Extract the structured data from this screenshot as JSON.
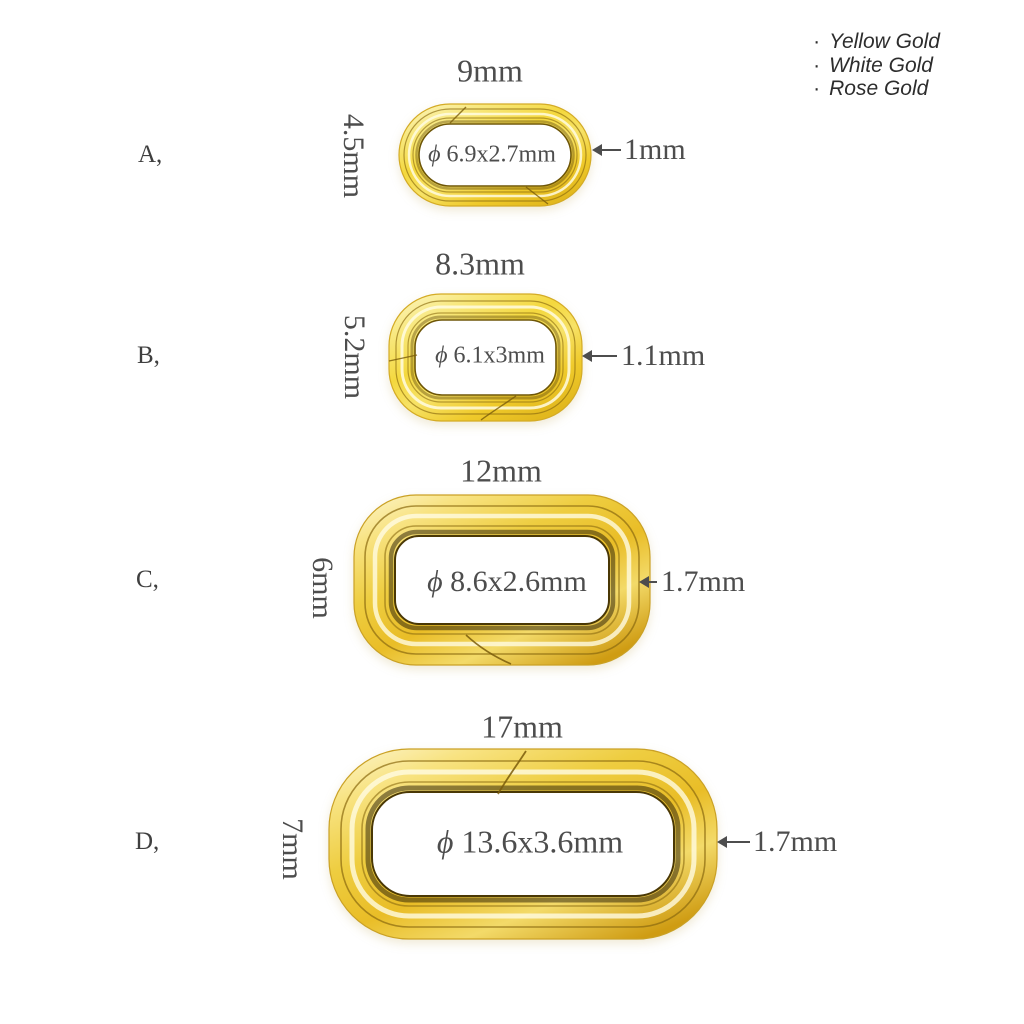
{
  "legend": {
    "bullet": "·",
    "items": [
      "Yellow Gold",
      "White Gold",
      "Rose Gold"
    ]
  },
  "sizes": [
    {
      "letter": "A,",
      "height_label": "4.5mm",
      "width_label": "9mm",
      "inner_label": "ϕ 6.9x2.7mm",
      "wire_label": "1mm"
    },
    {
      "letter": "B,",
      "height_label": "5.2mm",
      "width_label": "8.3mm",
      "inner_label": "ϕ 6.1x3mm",
      "wire_label": "1.1mm"
    },
    {
      "letter": "C,",
      "height_label": "6mm",
      "width_label": "12mm",
      "inner_label": "ϕ 8.6x2.6mm",
      "wire_label": "1.7mm"
    },
    {
      "letter": "D,",
      "height_label": "7mm",
      "width_label": "17mm",
      "inner_label": "ϕ 13.6x3.6mm",
      "wire_label": "1.7mm"
    }
  ],
  "colors": {
    "gold": "#f3d53c",
    "gold_deep": "#d9a81e",
    "text": "#4d4d4d",
    "legend_text": "#2d2d2d",
    "background": "#ffffff"
  }
}
